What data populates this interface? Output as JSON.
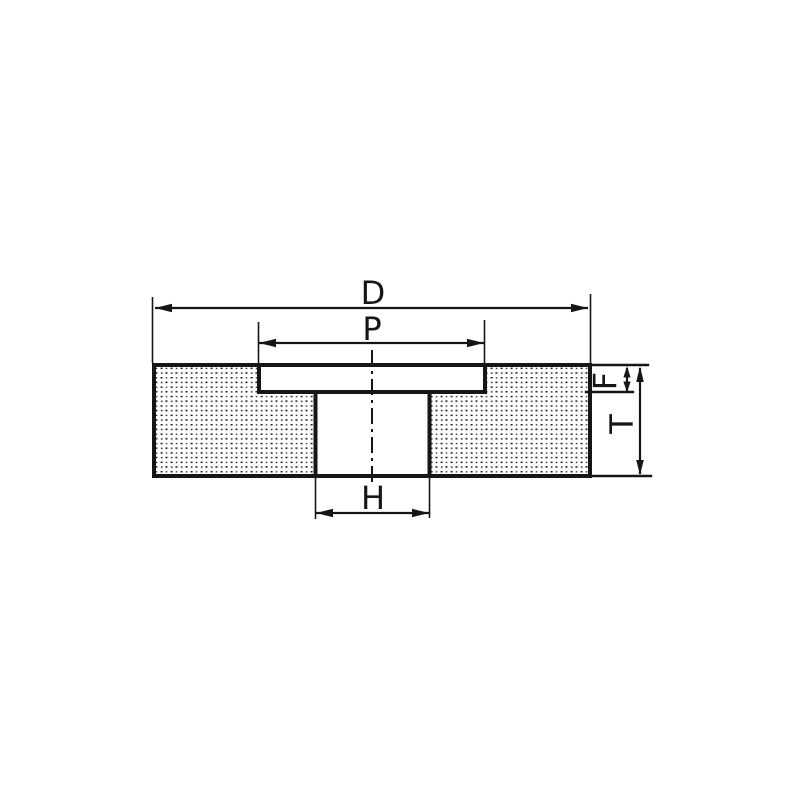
{
  "colors": {
    "ink": "#161616",
    "paper": "#ffffff"
  },
  "diagram": {
    "labels": {
      "outer_diameter": "D",
      "recess_diameter": "P",
      "recess_depth": "F",
      "thickness": "T",
      "bore_diameter": "H"
    }
  }
}
